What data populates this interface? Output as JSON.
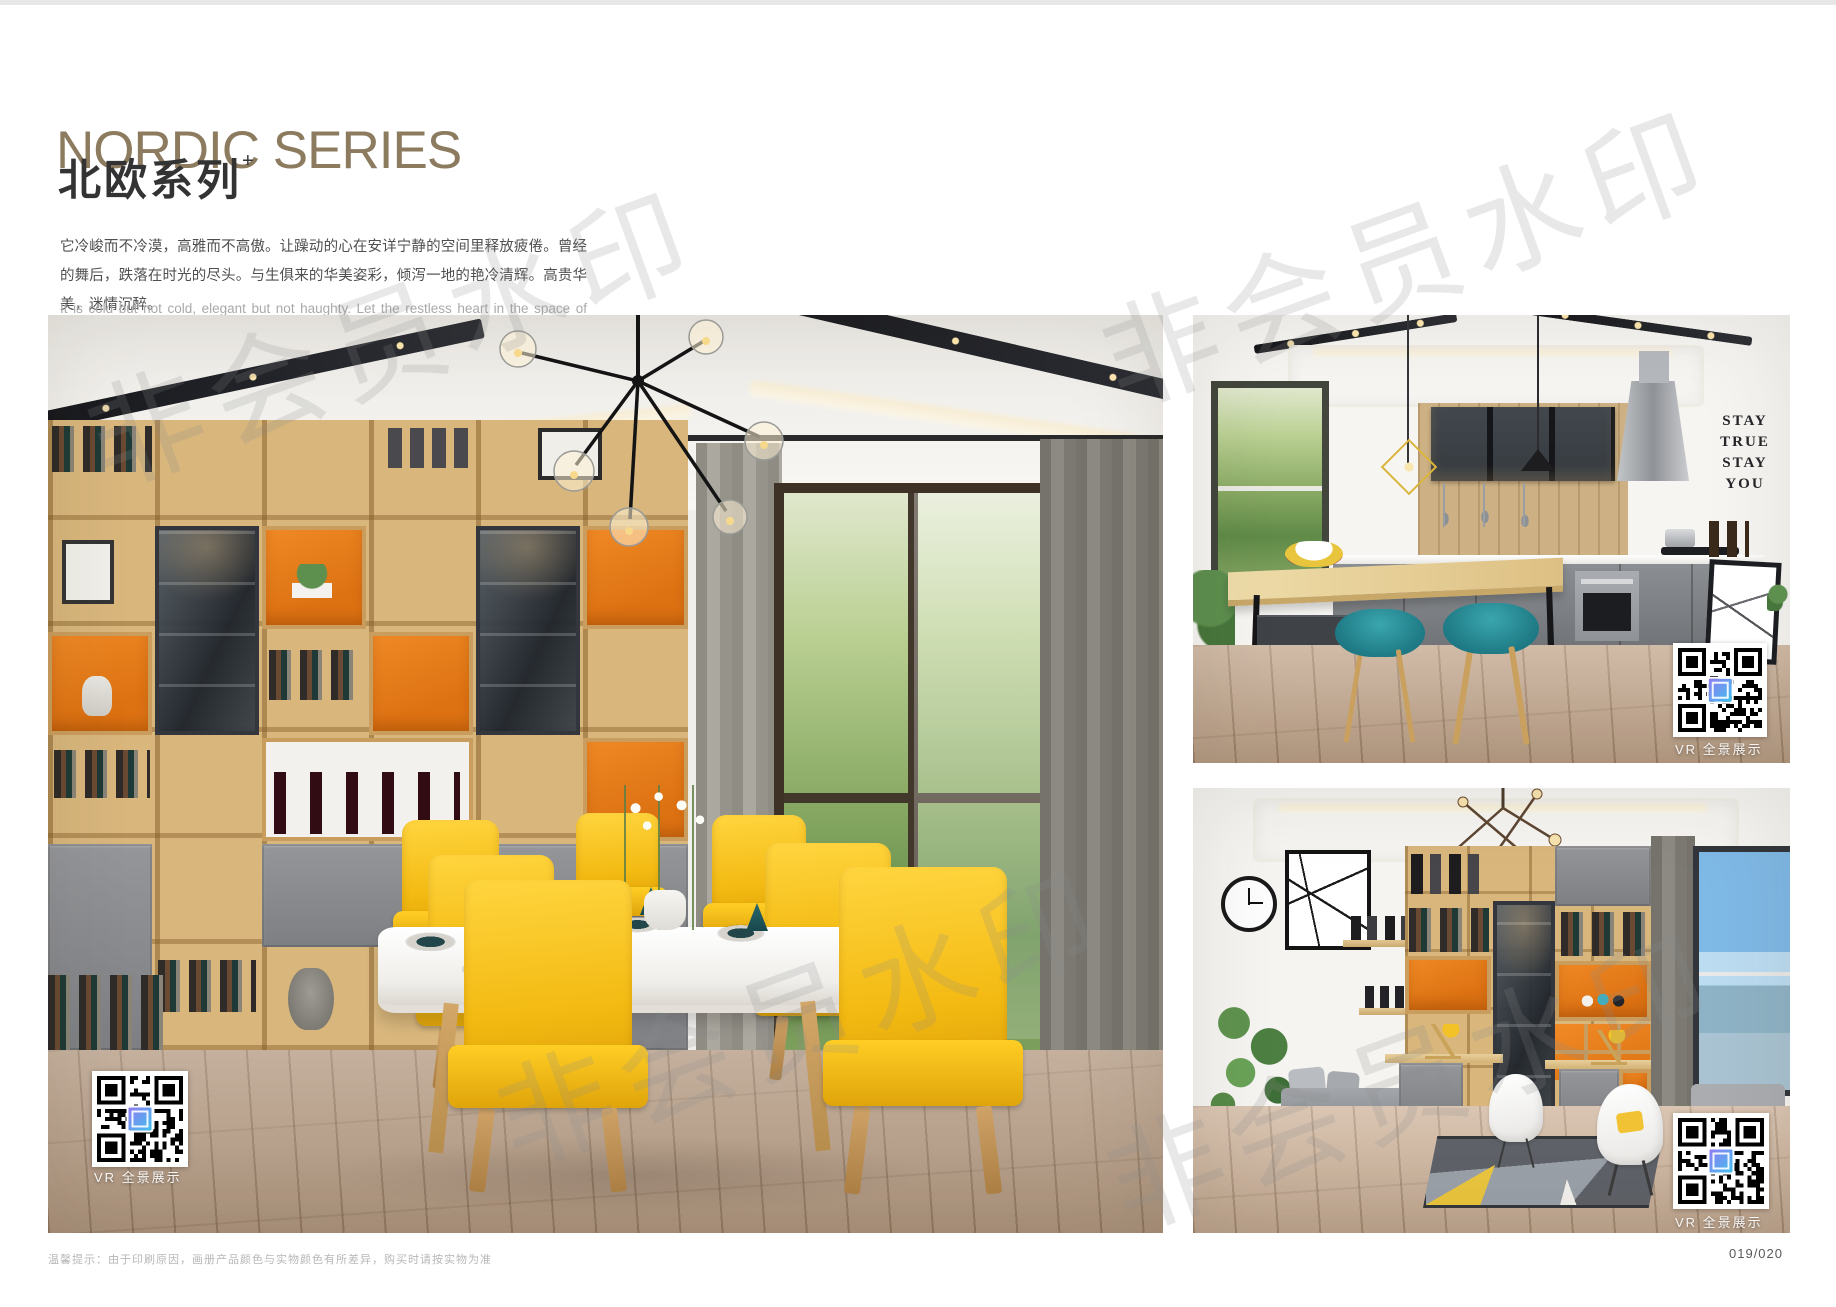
{
  "header": {
    "title": "NORDIC SERIES",
    "subtitle": "北欧系列",
    "subtitle_plus": "+",
    "desc_zh": "它冷峻而不冷漠，高雅而不高傲。让躁动的心在安详宁静的空间里释放疲倦。曾经的舞后，跌落在时光的尽头。与生俱来的华美姿彩，倾泻一地的艳冷清辉。高贵华美，迷情沉醉。",
    "desc_en": "It is cold but not cold, elegant but not haughty. Let the restless heart in the space of peace and tranquility release fatigue. Once the Queen of Dance, fall in the end of time. The natural beauty of the beautiful, pouring a land of cold and pure brilliance. Noble, beautiful, enchanted."
  },
  "watermark": {
    "text": "非会员水印"
  },
  "photos": {
    "vr_label": "VR 全景展示",
    "wall_text": {
      "line1": "STAY",
      "line2": "TRUE",
      "line3": "STAY",
      "line4": "YOU"
    }
  },
  "footer": {
    "note": "温馨提示：由于印刷原因，画册产品颜色与实物颜色有所差异，购买时请按实物为准",
    "page_number": "019/020"
  },
  "colors": {
    "title_bronze": "#8c7b5f",
    "accent_orange": "#e2791c",
    "accent_yellow": "#f3ba12",
    "accent_teal": "#27818d",
    "wood": "#d8b67c"
  }
}
